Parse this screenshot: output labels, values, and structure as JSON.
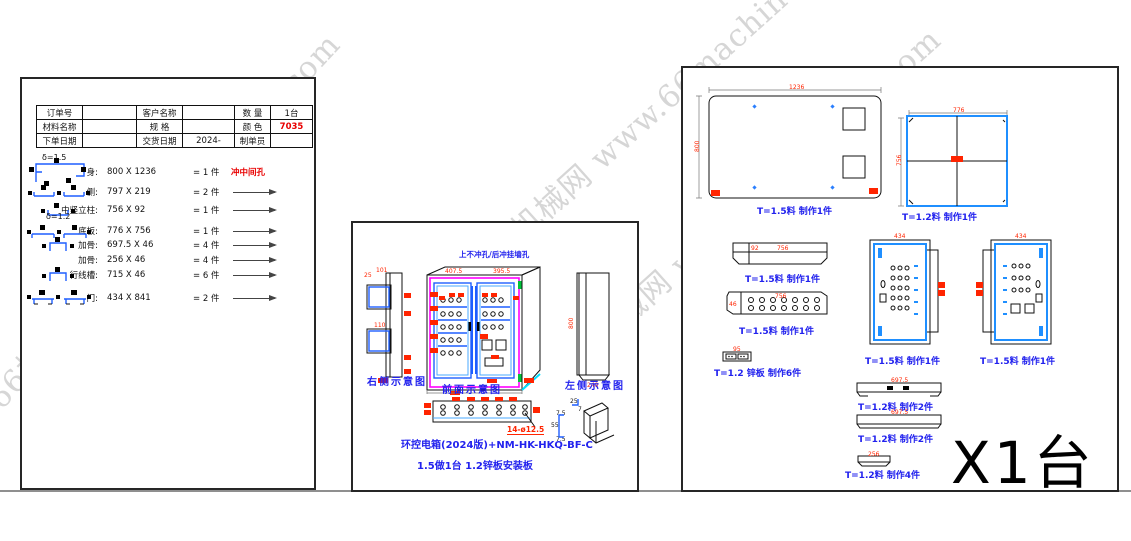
{
  "watermark": {
    "text": "66机械网 www.66machine.com"
  },
  "order_table": {
    "rows": [
      [
        "订单号",
        "",
        "客户名称",
        "",
        "数 量",
        "1台"
      ],
      [
        "材料名称",
        "",
        "规 格",
        "",
        "颜 色",
        "7035"
      ],
      [
        "下单日期",
        "",
        "交货日期",
        "2024-",
        "制单员",
        ""
      ]
    ]
  },
  "cut_list": {
    "group1": "δ=1.5",
    "group2": "δ=1.2",
    "parts": [
      {
        "name": "身:",
        "dims": "800  X 1236",
        "qty": "= 1 件",
        "note": "冲中间孔"
      },
      {
        "name": "侧:",
        "dims": "797  X 219",
        "qty": "= 2 件"
      },
      {
        "name": "中竖立柱:",
        "dims": "756  X 92",
        "qty": "= 1 件"
      },
      {
        "name": "底板:",
        "dims": "776  X 756",
        "qty": "= 1 件"
      },
      {
        "name": "加骨:",
        "dims": "697.5 X 46",
        "qty": "= 4 件"
      },
      {
        "name": "加骨:",
        "dims": "256  X 46",
        "qty": "= 4 件"
      },
      {
        "name": "行线槽:",
        "dims": "715  X 46",
        "qty": "= 6 件"
      },
      {
        "name": "门:",
        "dims": "434  X 841",
        "qty": "= 2 件"
      }
    ]
  },
  "assembly": {
    "top_note": "上不冲孔/后冲挂墙孔",
    "view_right": "右侧示意图",
    "view_front": "前面示意图",
    "view_left": "左侧示意图",
    "hole_callout": "14-ø12.5",
    "model_caption": "环控电箱(2024版)+NM-HK-HKQ-BF-C",
    "spec_caption": "1.5做1台  1.2锌板安装板",
    "dims": {
      "front_w_left": "407.5",
      "front_w_right": "395.5",
      "side_h": "800",
      "side_d": "240",
      "r_off": "25",
      "r_top": "101",
      "r_mid": "110",
      "profile_w": "25",
      "profile_t": "7",
      "profile_f1": "7.5",
      "profile_h": "55",
      "profile_f2": "7.5"
    }
  },
  "parts_sheet": {
    "quantity": "X1台",
    "items": [
      {
        "label": "T=1.5料  制作1件",
        "w": "1236",
        "h": "800"
      },
      {
        "label": "T=1.2料  制作1件",
        "w": "776",
        "h": "756"
      },
      {
        "label": "T=1.5料  制作1件",
        "w": "756",
        "h": "92"
      },
      {
        "label": "T=1.5料  制作1件",
        "w": "756",
        "h": "46"
      },
      {
        "label": "T=1.2 锌板  制作6件",
        "w": "95"
      },
      {
        "label": "T=1.5料  制作1件",
        "w": "434",
        "h": "841"
      },
      {
        "label": "T=1.5料  制作1件",
        "w": "434",
        "h": "841"
      },
      {
        "label": "T=1.2料  制作2件",
        "w": "697.5"
      },
      {
        "label": "T=1.2料  制作2件",
        "w": "697.5"
      },
      {
        "label": "T=1.2料  制作4件",
        "w": "256"
      }
    ]
  }
}
